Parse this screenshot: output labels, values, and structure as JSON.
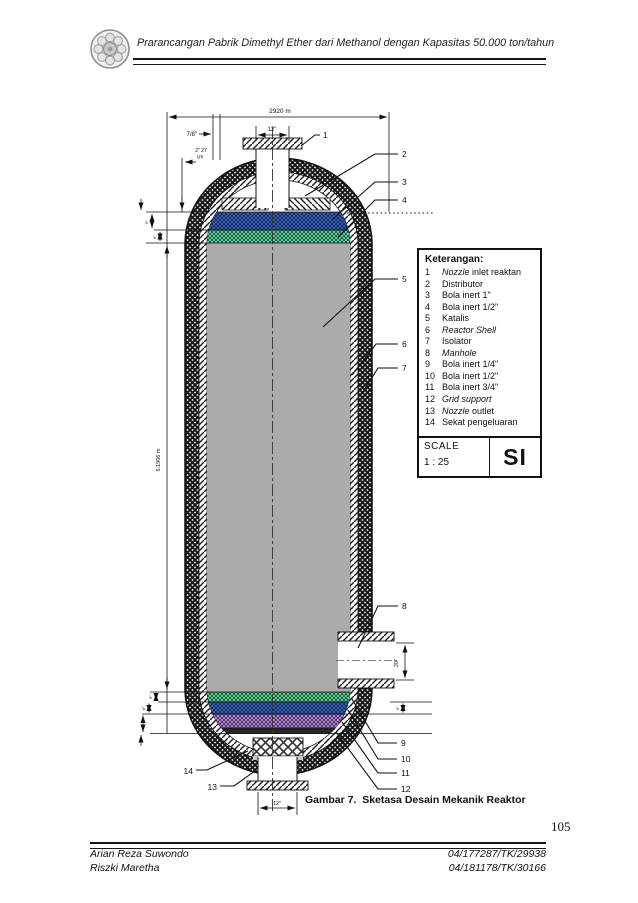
{
  "header": {
    "title": "Prarancangan Pabrik Dimethyl Ether dari Methanol dengan Kapasitas 50.000 ton/tahun",
    "logo": "ugm-emblem"
  },
  "legend": {
    "title": "Keterangan:",
    "items": [
      {
        "no": "1",
        "em": "Nozzle",
        "text": " inlet reaktan"
      },
      {
        "no": "2",
        "em": "",
        "text": "Distributor"
      },
      {
        "no": "3",
        "em": "",
        "text": "Bola inert 1\""
      },
      {
        "no": "4",
        "em": "",
        "text": "Bola inert 1/2\""
      },
      {
        "no": "5",
        "em": "",
        "text": "Katalis"
      },
      {
        "no": "6",
        "em": "Reactor Shell",
        "text": ""
      },
      {
        "no": "7",
        "em": "",
        "text": "Isolator"
      },
      {
        "no": "8",
        "em": "Manhole",
        "text": ""
      },
      {
        "no": "9",
        "em": "",
        "text": "Bola inert 1/4\""
      },
      {
        "no": "10",
        "em": "",
        "text": "Bola inert 1/2\""
      },
      {
        "no": "11",
        "em": "",
        "text": "Bola inert 3/4\""
      },
      {
        "no": "12",
        "em": "Grid support",
        "text": ""
      },
      {
        "no": "13",
        "em": "Nozzle",
        "text": " outlet"
      },
      {
        "no": "14",
        "em": "",
        "text": "Sekat pengeluaran"
      }
    ]
  },
  "scale": {
    "label": "SCALE",
    "value": "1 : 25",
    "si": "SI"
  },
  "drawing": {
    "callouts": [
      "1",
      "2",
      "3",
      "4",
      "5",
      "6",
      "7",
      "8",
      "9",
      "10",
      "11",
      "12",
      "13",
      "14"
    ],
    "dims": {
      "overall_width": "2920 m",
      "nozzle_top": "12\"",
      "shell_thk": "7/8\"",
      "head_a": "2\" 27",
      "head_b": "cm",
      "height": "5.1906 m",
      "manhole": "20\"",
      "nozzle_bottom": "12\"",
      "tiny": "6\""
    }
  },
  "colors": {
    "inert_blue": "#3f6fd0",
    "inert_green": "#72e2ac",
    "inert_purple": "#c59de4",
    "catalyst": "#ababab"
  },
  "caption": {
    "figure": "Gambar 7.",
    "title": "Sketasa Desain Mekanik Reaktor"
  },
  "page": {
    "number": "105"
  },
  "footer": {
    "authors": [
      {
        "name": "Arian Reza Suwondo",
        "id": "04/177287/TK/29938"
      },
      {
        "name": "Riszki Maretha",
        "id": "04/181178/TK/30166"
      }
    ]
  }
}
